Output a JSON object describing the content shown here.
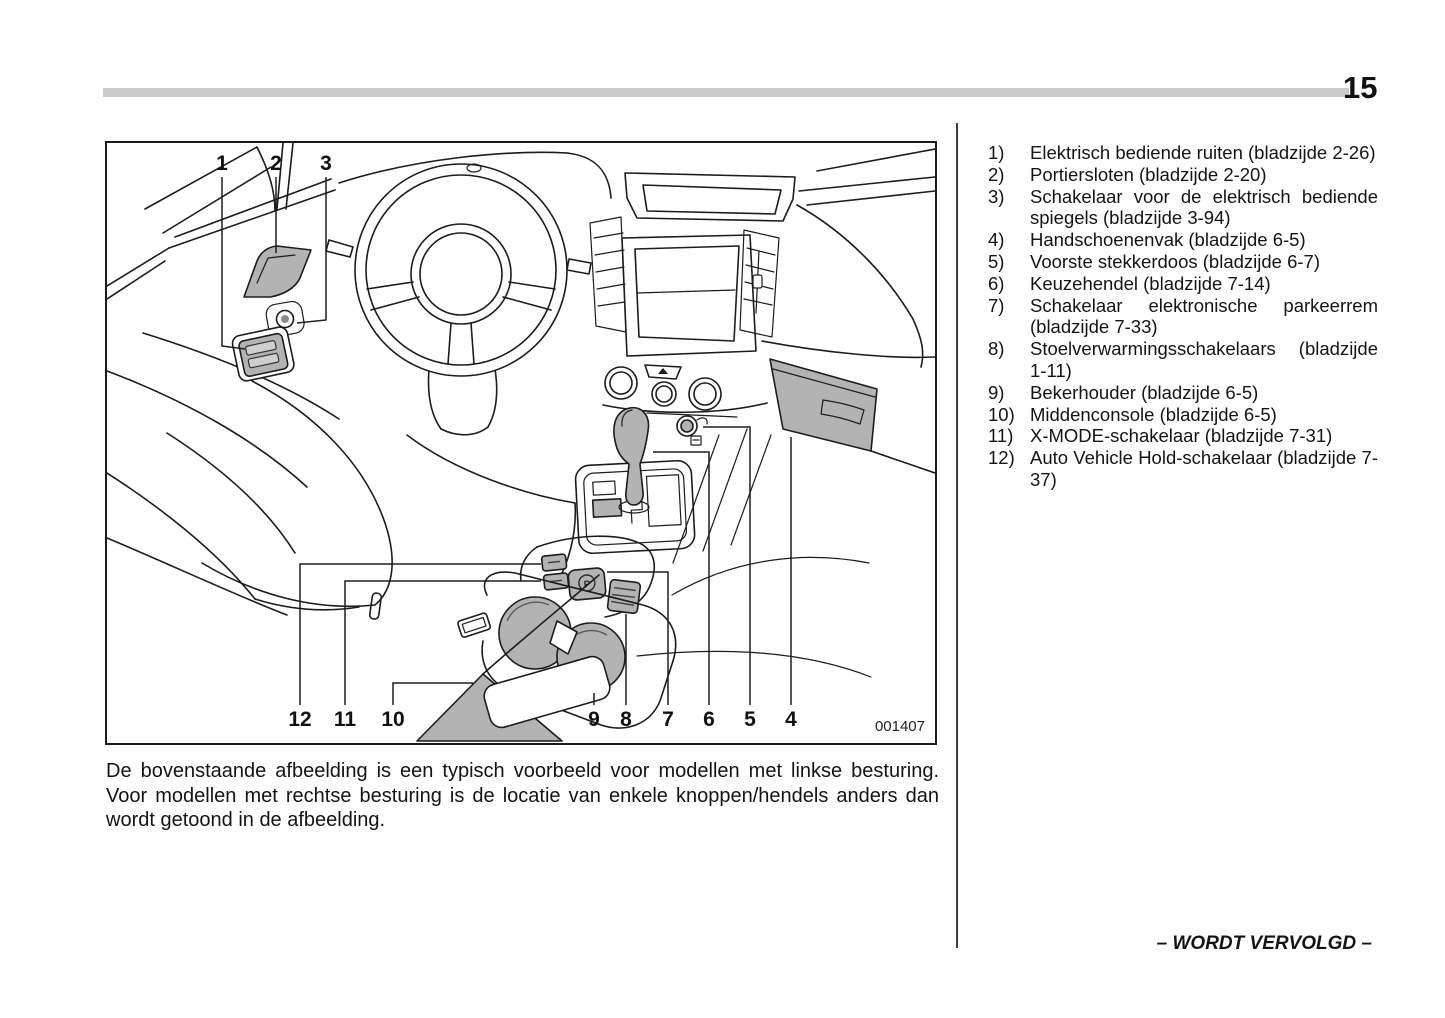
{
  "page": {
    "number": "15"
  },
  "figure": {
    "code": "001407",
    "park_icon": "P",
    "callouts_top": [
      "1",
      "2",
      "3"
    ],
    "callouts_bottom": [
      "12",
      "11",
      "10",
      "9",
      "8",
      "7",
      "6",
      "5",
      "4"
    ]
  },
  "caption": "De bovenstaande afbeelding is een typisch voorbeeld voor modellen met linkse besturing. Voor modellen met rechtse besturing is de locatie van enkele knoppen/hendels anders dan wordt getoond in de afbeelding.",
  "legend": [
    {
      "num": "1)",
      "text": "Elektrisch bediende ruiten (bladzijde 2-26)"
    },
    {
      "num": "2)",
      "text": "Portiersloten (bladzijde 2-20)"
    },
    {
      "num": "3)",
      "text": "Schakelaar voor de elektrisch bediende spiegels (bladzijde 3-94)"
    },
    {
      "num": "4)",
      "text": "Handschoenenvak (bladzijde 6-5)"
    },
    {
      "num": "5)",
      "text": "Voorste stekkerdoos (bladzijde 6-7)"
    },
    {
      "num": "6)",
      "text": "Keuzehendel (bladzijde 7-14)"
    },
    {
      "num": "7)",
      "text": "Schakelaar elektronische parkeerrem (bladzijde 7-33)"
    },
    {
      "num": "8)",
      "text": "Stoelverwarmingsschakelaars (bladzijde 1-11)"
    },
    {
      "num": "9)",
      "text": "Bekerhouder (bladzijde 6-5)"
    },
    {
      "num": "10)",
      "text": "Middenconsole (bladzijde 6-5)"
    },
    {
      "num": "11)",
      "text": "X-MODE-schakelaar (bladzijde 7-31)"
    },
    {
      "num": "12)",
      "text": "Auto Vehicle Hold-schakelaar (bladzijde 7-37)"
    }
  ],
  "footer": {
    "continued": "– WORDT VERVOLGD –"
  },
  "colors": {
    "shade": "#b3b3b3",
    "rule": "#c9c9c9",
    "line": "#1c1c1c"
  }
}
